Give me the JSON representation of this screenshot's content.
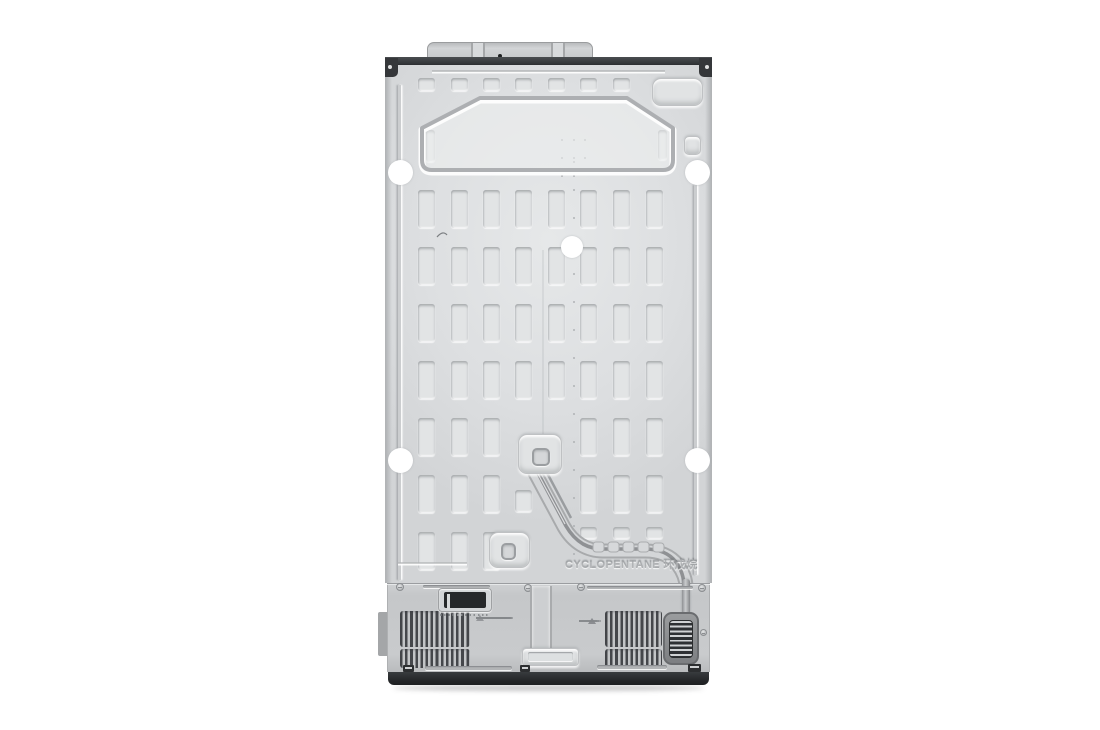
{
  "image": {
    "subject": "refrigerator-back-panel-photo",
    "embossed_text": "CYCLOPENTANE 环戊烷",
    "colors": {
      "background": "#ffffff",
      "panel_face": "#dcdee0",
      "panel_bright": "#e6e8e9",
      "top_bar": "#3b3e41",
      "cover": "#c8cacc",
      "base": "#2b2d2f",
      "grille_slat": "#45474b",
      "fan_window": "#2e3033",
      "hole_white": "#ffffff"
    }
  },
  "layout": {
    "top_rects": {
      "x": [
        33,
        66,
        98,
        130,
        163,
        195,
        228
      ],
      "y": 43,
      "w": 17,
      "h": 13
    },
    "hex_slots": [
      [
        41,
        95,
        9,
        32
      ],
      [
        273,
        95,
        9,
        30
      ]
    ],
    "grid": {
      "col_x": [
        33,
        66,
        98,
        130,
        163,
        195,
        228,
        261
      ],
      "row_y": [
        155,
        212,
        269,
        326,
        383,
        440,
        497
      ],
      "slot_w": 17,
      "slot_h": 38,
      "omit": [
        "4-3",
        "4-4",
        "5-4",
        "6-3",
        "6-4"
      ],
      "short": [
        {
          "r": 5,
          "c": 3,
          "y": 455,
          "h": 22
        },
        {
          "r": 6,
          "c": 5,
          "y": 492,
          "h": 12
        },
        {
          "r": 6,
          "c": 6,
          "y": 492,
          "h": 12
        },
        {
          "r": 6,
          "c": 7,
          "y": 492,
          "h": 12
        }
      ]
    },
    "circles": [
      {
        "x": 15,
        "y": 137,
        "r": 12.5
      },
      {
        "x": 312,
        "y": 137,
        "r": 12.5
      },
      {
        "x": 187,
        "y": 212,
        "r": 11
      },
      {
        "x": 15,
        "y": 425,
        "r": 12.5
      },
      {
        "x": 312,
        "y": 425,
        "r": 12.5
      }
    ],
    "dot_column": {
      "x": 188,
      "y0": 126,
      "step": 28,
      "count": 15
    },
    "hex_dots": [
      [
        176,
        104
      ],
      [
        188,
        104
      ],
      [
        199,
        104
      ],
      [
        176,
        122
      ],
      [
        188,
        122
      ],
      [
        199,
        122
      ],
      [
        188,
        140
      ],
      [
        176,
        140
      ]
    ]
  }
}
